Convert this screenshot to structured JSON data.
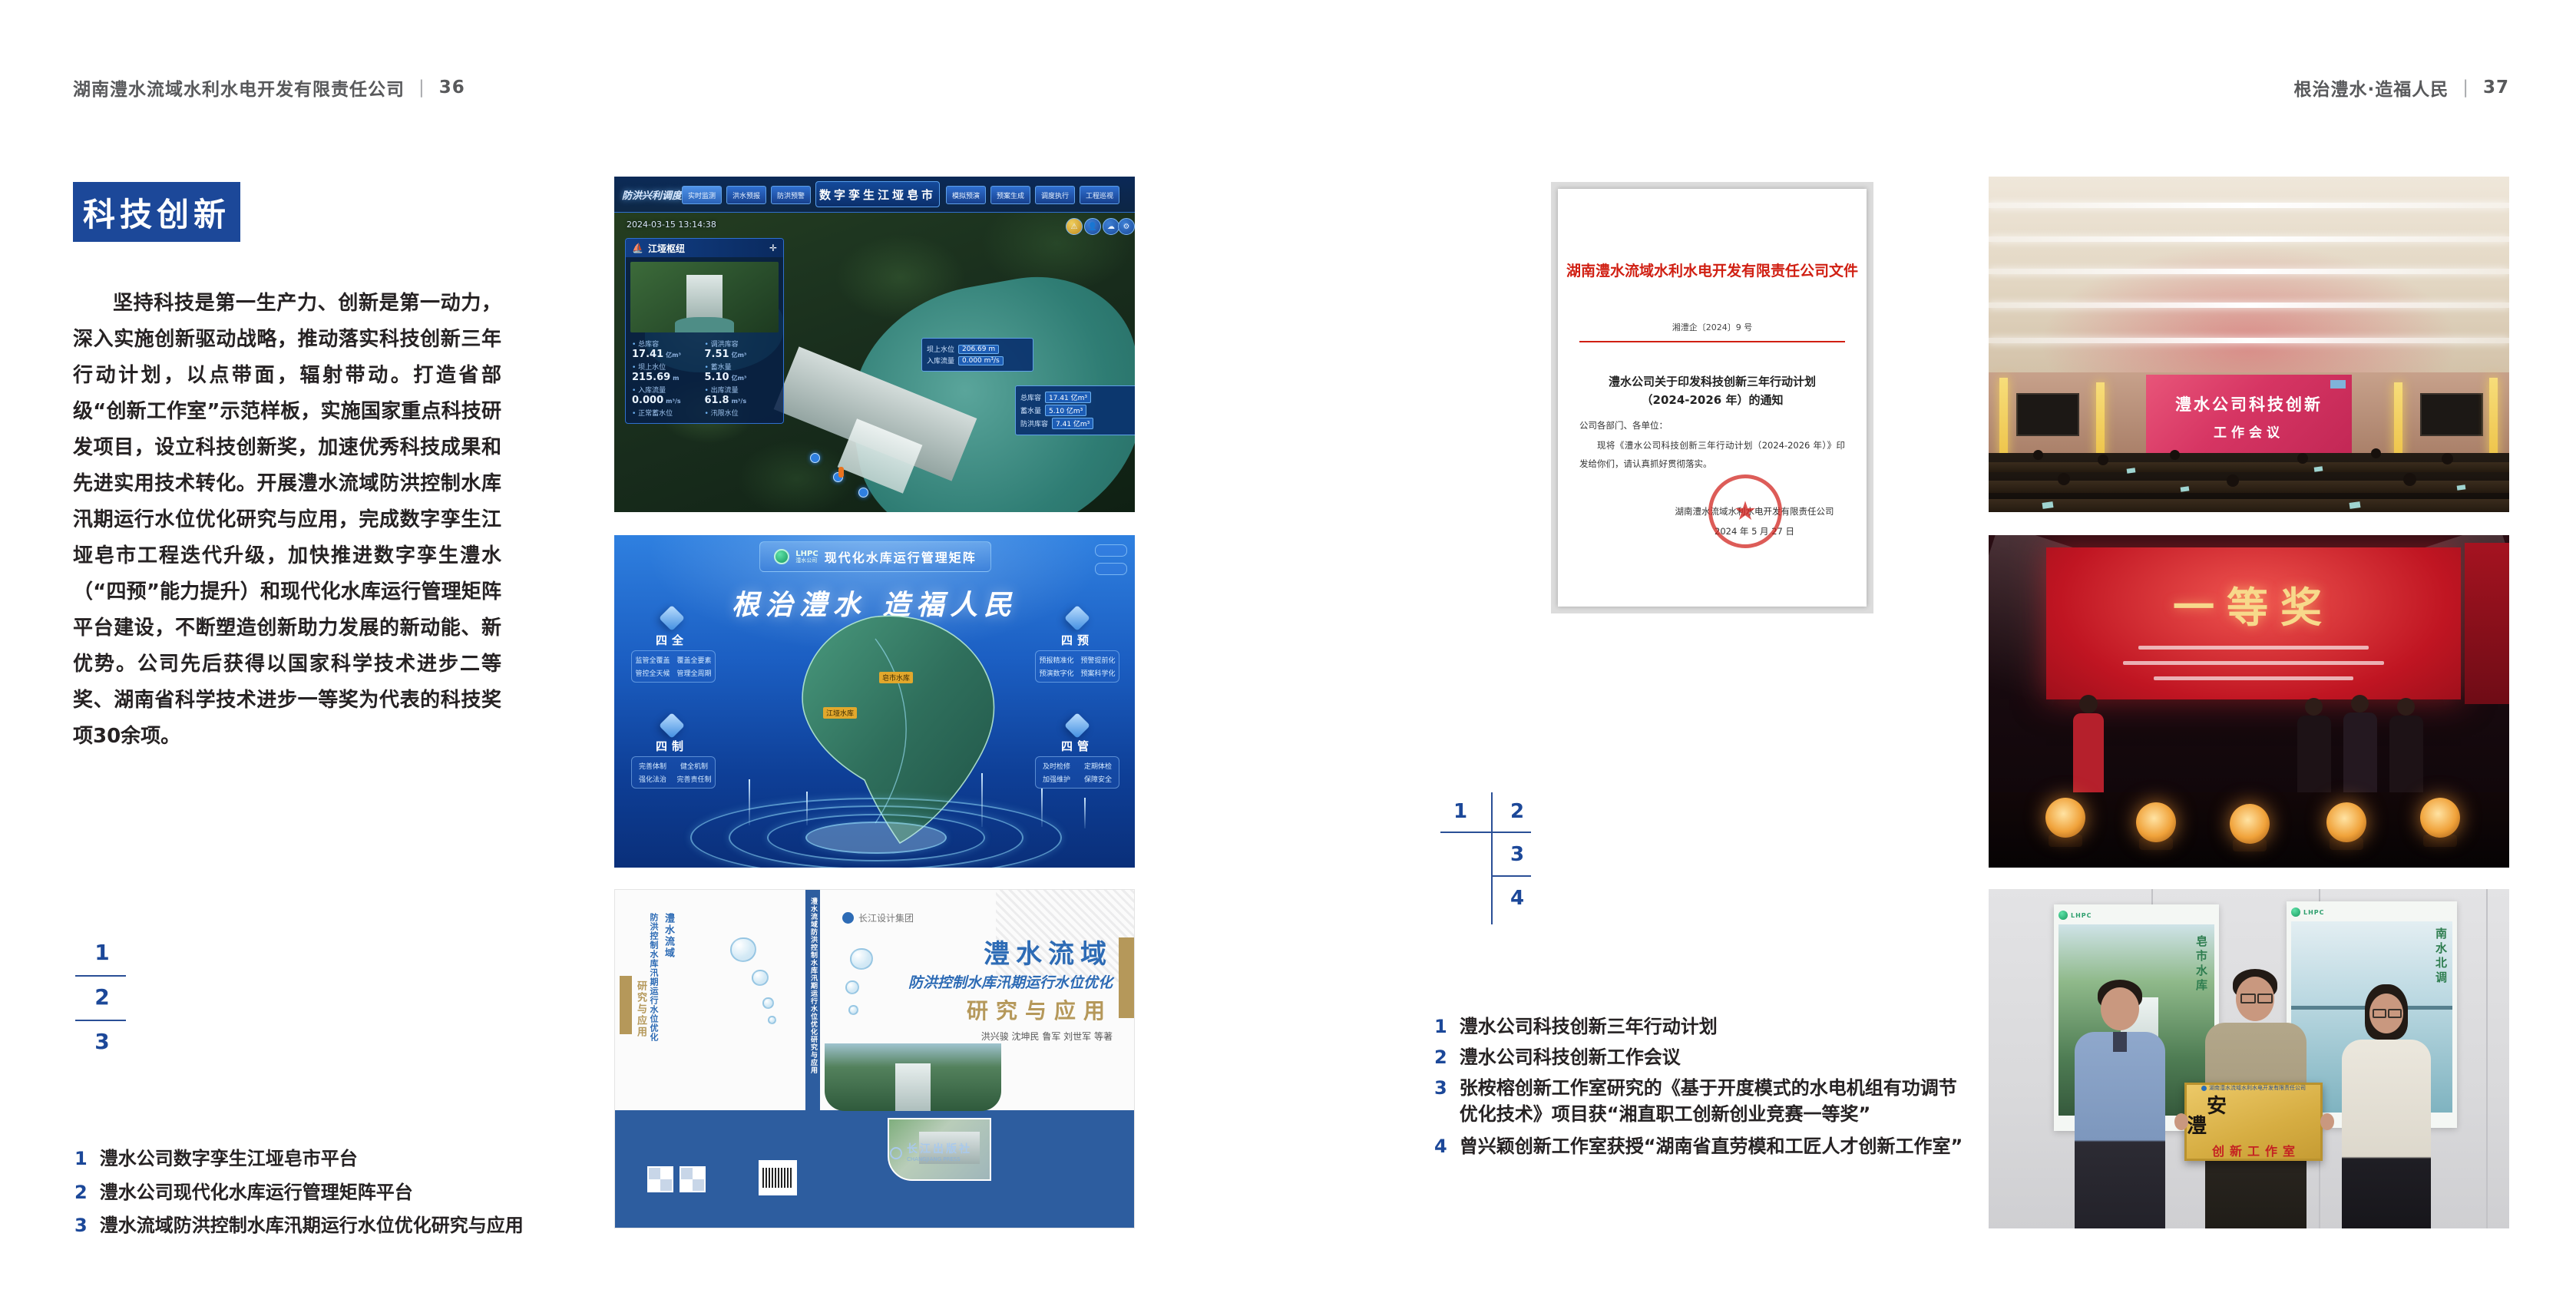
{
  "left_page": {
    "header": {
      "company": "湖南澧水流域水利水电开发有限责任公司",
      "divider": "|",
      "page": "36"
    },
    "section_title": "科技创新",
    "paragraph": "坚持科技是第一生产力、创新是第一动力，深入实施创新驱动战略，推动落实科技创新三年行动计划，以点带面，辐射带动。打造省部级“创新工作室”示范样板，实施国家重点科技研发项目，设立科技创新奖，加速优秀科技成果和先进实用技术转化。开展澧水流域防洪控制水库汛期运行水位优化研究与应用，完成数字孪生江垭皂市工程迭代升级，加快推进数字孪生澧水（“四预”能力提升）和现代化水库运行管理矩阵平台建设，不断塑造创新助力发展的新动能、新优势。公司先后获得以国家科学技术进步二等奖、湖南省科学技术进步一等奖为代表的科技奖项30余项。",
    "figure_nums": [
      "1",
      "2",
      "3"
    ],
    "captions": [
      {
        "num": "1",
        "text": "澧水公司数字孪生江垭皂市平台"
      },
      {
        "num": "2",
        "text": "澧水公司现代化水库运行管理矩阵平台"
      },
      {
        "num": "3",
        "text": "澧水流域防洪控制水库汛期运行水位优化研究与应用"
      }
    ]
  },
  "right_page": {
    "header": {
      "slogan": "根治澧水·造福人民",
      "divider": "|",
      "page": "37"
    },
    "figure_nums": [
      "1",
      "2",
      "3",
      "4"
    ],
    "captions": [
      {
        "num": "1",
        "text": "澧水公司科技创新三年行动计划"
      },
      {
        "num": "2",
        "text": "澧水公司科技创新工作会议"
      },
      {
        "num": "3",
        "text": "张桉榕创新工作室研究的《基于开度模式的水电机组有功调节优化技术》项目获“湘直职工创新创业竞赛一等奖”"
      },
      {
        "num": "4",
        "text": "曾兴颖创新工作室获授“湖南省直劳模和工匠人才创新工作室”"
      }
    ]
  },
  "dashboard": {
    "title": "数字孪生江垭皂市",
    "subtitle_left": "防洪兴利调度",
    "tabs_left": [
      "实时监测",
      "洪水预报",
      "防洪预警"
    ],
    "tabs_right": [
      "模拟预演",
      "预案生成",
      "调度执行",
      "工程巡视"
    ],
    "timestamp": "2024-03-15 13:14:38",
    "panel": {
      "title": "江垭枢纽",
      "stats": [
        {
          "label": "总库容",
          "value": "17.41",
          "unit": "亿m³"
        },
        {
          "label": "调洪库容",
          "value": "7.51",
          "unit": "亿m³"
        },
        {
          "label": "坝上水位",
          "value": "215.69",
          "unit": "m"
        },
        {
          "label": "蓄水量",
          "value": "5.10",
          "unit": "亿m³"
        },
        {
          "label": "入库流量",
          "value": "0.000",
          "unit": "m³/s"
        },
        {
          "label": "出库流量",
          "value": "61.8",
          "unit": "m³/s"
        },
        {
          "label": "正常蓄水位",
          "value": "",
          "unit": ""
        },
        {
          "label": "汛限水位",
          "value": "",
          "unit": ""
        }
      ]
    },
    "tooltip": {
      "rows": [
        {
          "label": "坝上水位",
          "value": "206.69 m"
        },
        {
          "label": "入库流量",
          "value": "0.000 m³/s"
        }
      ]
    },
    "info_box": {
      "rows": [
        {
          "label": "总库容",
          "value": "17.41 亿m³"
        },
        {
          "label": "蓄水量",
          "value": "5.10 亿m³"
        },
        {
          "label": "防洪库容",
          "value": "7.41 亿m³"
        }
      ]
    }
  },
  "matrix": {
    "logo_text": "LHPC",
    "logo_sub": "澧水公司",
    "title": "现代化水库运行管理矩阵",
    "slogan": "根治澧水 造福人民",
    "quadrants": [
      {
        "name": "四全",
        "items": [
          "监管全覆盖",
          "覆盖全要素",
          "管控全天候",
          "管理全周期"
        ]
      },
      {
        "name": "四预",
        "items": [
          "预报精准化",
          "预警提前化",
          "预演数字化",
          "预案科学化"
        ]
      },
      {
        "name": "四制",
        "items": [
          "完善体制",
          "健全机制",
          "强化法治",
          "完善责任制"
        ]
      },
      {
        "name": "四管",
        "items": [
          "及时检修",
          "定期体检",
          "加强维护",
          "保障安全"
        ]
      }
    ],
    "map_labels": [
      "皂市水库",
      "江垭水库"
    ]
  },
  "book": {
    "brand": "长江设计集团",
    "title_line1": "澧水流域",
    "title_line2": "防洪控制水库汛期运行水位优化",
    "title_line3": "研究与应用",
    "authors": "洪兴骏 沈坤民 鲁军 刘世军 等著",
    "spine_title": "澧水流域防洪控制水库汛期运行水位优化研究与应用",
    "publisher": "长江出版社",
    "publisher_en": "CHANGJIANG PRESS"
  },
  "document": {
    "header": "湖南澧水流域水利水电开发有限责任公司文件",
    "doc_no": "湘澧企〔2024〕9 号",
    "title_line1": "澧水公司关于印发科技创新三年行动计划",
    "title_line2": "（2024-2026 年）的通知",
    "salutation": "公司各部门、各单位：",
    "body": "现将《澧水公司科技创新三年行动计划（2024-2026 年）》印发给你们，请认真抓好贯彻落实。",
    "signature": "湖南澧水流域水利水电开发有限责任公司",
    "date": "2024 年 5 月 27 日",
    "seal_star": "★"
  },
  "meeting": {
    "screen_line1": "澧水公司科技创新",
    "screen_line2": "工作会议"
  },
  "stage": {
    "screen_text": "一等奖"
  },
  "plaque": {
    "org_line": "湖南澧水流域水利水电开发有限责任公司",
    "name": "安　澧",
    "label": "创新工作室",
    "poster_logo": "LHPC",
    "poster_left_text": "皂市水库",
    "poster_right_text": "南水北调"
  }
}
